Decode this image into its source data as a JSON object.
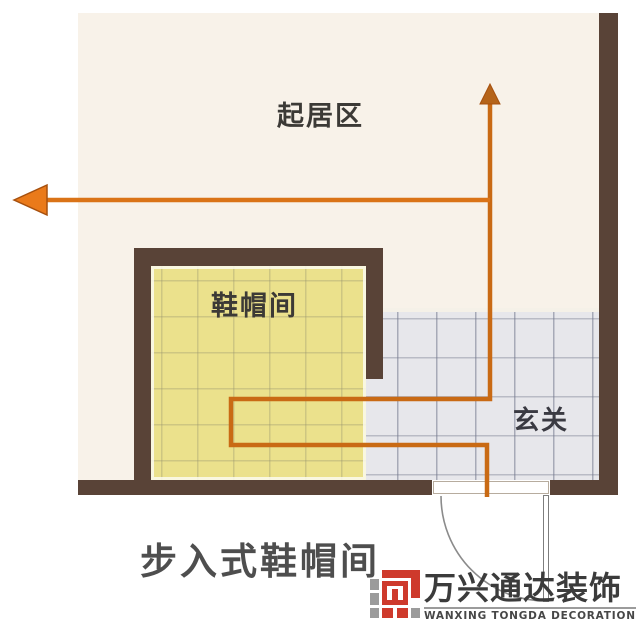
{
  "diagram": {
    "caption": "步入式鞋帽间",
    "rooms": {
      "living_area": "起居区",
      "cloakroom": "鞋帽间",
      "entry": "玄关"
    },
    "watermark": {
      "name_cn": "万兴通达装饰",
      "name_en": "WANXING TONGDA DECORATION"
    },
    "colors": {
      "wall_brown": "#594337",
      "floor_living_cream": "#f8f2e9",
      "floor_cloakroom_yellow": "#ebe18c",
      "floor_entry_gray": "#e7e7eb",
      "circulation_path_orange": "#c96a14",
      "arrowhead_orange": "#ea7a1a",
      "logo_red": "#ce3a2c",
      "logo_gray": "#9b9b9b"
    },
    "icons": {
      "arrow_left": "circulation-arrow-left",
      "arrow_up": "circulation-arrow-up",
      "door_swing": "door-swing-arc"
    }
  }
}
